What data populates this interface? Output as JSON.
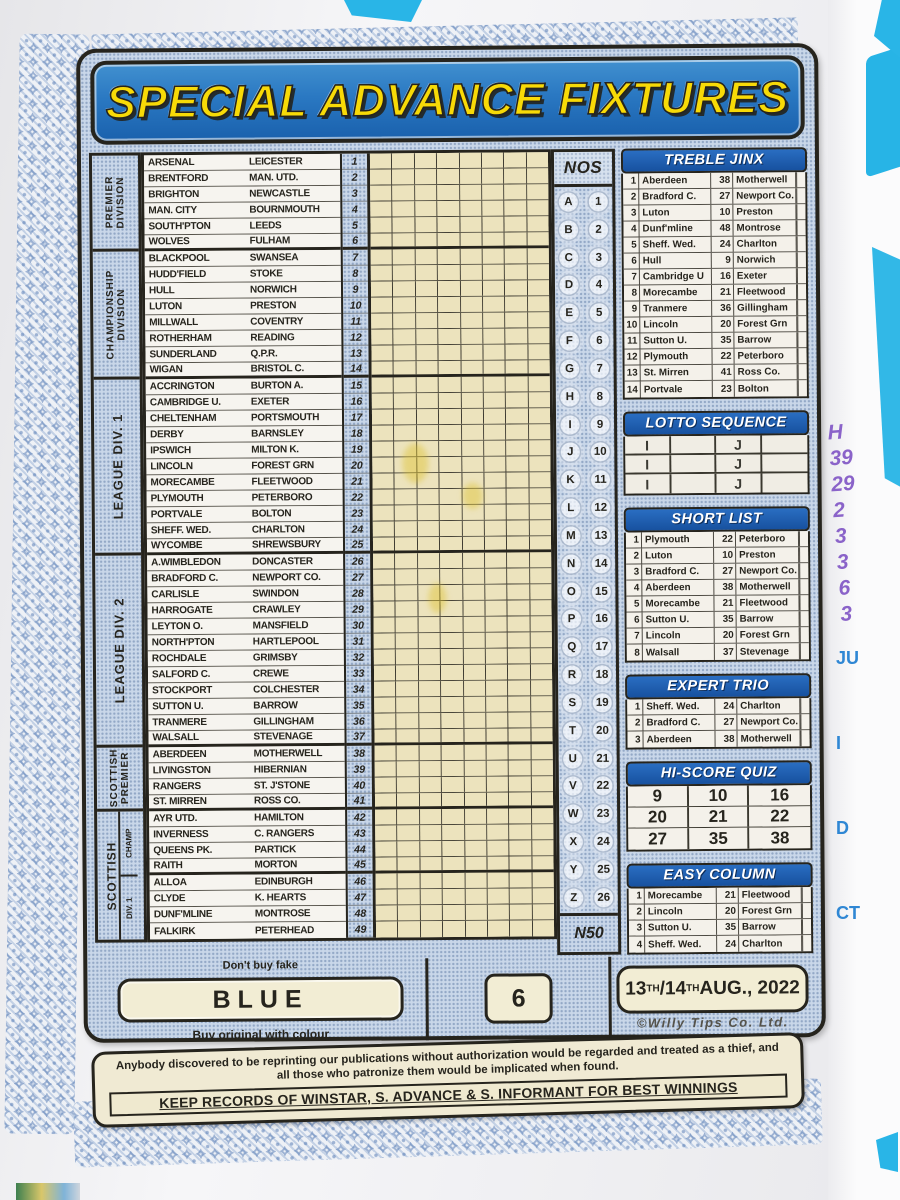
{
  "title": "SPECIAL ADVANCE FIXTURES",
  "divisions": [
    {
      "label1": "PREMIER",
      "label2": "DIVISION",
      "rows": 6
    },
    {
      "label1": "CHAMPIONSHIP",
      "label2": "DIVISION",
      "rows": 8
    },
    {
      "label1": "LEAGUE DIV. 1",
      "label2": "",
      "rows": 11
    },
    {
      "label1": "LEAGUE DIV. 2",
      "label2": "",
      "rows": 12
    },
    {
      "label1": "SCOTTISH",
      "label2": "PREMIER",
      "rows": 4
    },
    {
      "label1": "SCOTTISH",
      "label2": "",
      "rows": 8,
      "sub": [
        {
          "label": "CHAMP",
          "rows": 4
        },
        {
          "label": "DIV. 1",
          "rows": 4
        }
      ]
    }
  ],
  "fixtures": [
    {
      "no": "1",
      "home": "ARSENAL",
      "away": "LEICESTER"
    },
    {
      "no": "2",
      "home": "BRENTFORD",
      "away": "MAN. UTD."
    },
    {
      "no": "3",
      "home": "BRIGHTON",
      "away": "NEWCASTLE"
    },
    {
      "no": "4",
      "home": "MAN. CITY",
      "away": "BOURNMOUTH"
    },
    {
      "no": "5",
      "home": "SOUTH'PTON",
      "away": "LEEDS"
    },
    {
      "no": "6",
      "home": "WOLVES",
      "away": "FULHAM"
    },
    {
      "no": "7",
      "home": "BLACKPOOL",
      "away": "SWANSEA"
    },
    {
      "no": "8",
      "home": "HUDD'FIELD",
      "away": "STOKE"
    },
    {
      "no": "9",
      "home": "HULL",
      "away": "NORWICH"
    },
    {
      "no": "10",
      "home": "LUTON",
      "away": "PRESTON"
    },
    {
      "no": "11",
      "home": "MILLWALL",
      "away": "COVENTRY"
    },
    {
      "no": "12",
      "home": "ROTHERHAM",
      "away": "READING"
    },
    {
      "no": "13",
      "home": "SUNDERLAND",
      "away": "Q.P.R."
    },
    {
      "no": "14",
      "home": "WIGAN",
      "away": "BRISTOL C."
    },
    {
      "no": "15",
      "home": "ACCRINGTON",
      "away": "BURTON A."
    },
    {
      "no": "16",
      "home": "CAMBRIDGE U.",
      "away": "EXETER"
    },
    {
      "no": "17",
      "home": "CHELTENHAM",
      "away": "PORTSMOUTH"
    },
    {
      "no": "18",
      "home": "DERBY",
      "away": "BARNSLEY"
    },
    {
      "no": "19",
      "home": "IPSWICH",
      "away": "MILTON K."
    },
    {
      "no": "20",
      "home": "LINCOLN",
      "away": "FOREST GRN"
    },
    {
      "no": "21",
      "home": "MORECAMBE",
      "away": "FLEETWOOD"
    },
    {
      "no": "22",
      "home": "PLYMOUTH",
      "away": "PETERBORO"
    },
    {
      "no": "23",
      "home": "PORTVALE",
      "away": "BOLTON"
    },
    {
      "no": "24",
      "home": "SHEFF. WED.",
      "away": "CHARLTON"
    },
    {
      "no": "25",
      "home": "WYCOMBE",
      "away": "SHREWSBURY"
    },
    {
      "no": "26",
      "home": "A.WIMBLEDON",
      "away": "DONCASTER"
    },
    {
      "no": "27",
      "home": "BRADFORD C.",
      "away": "NEWPORT CO."
    },
    {
      "no": "28",
      "home": "CARLISLE",
      "away": "SWINDON"
    },
    {
      "no": "29",
      "home": "HARROGATE",
      "away": "CRAWLEY"
    },
    {
      "no": "30",
      "home": "LEYTON O.",
      "away": "MANSFIELD"
    },
    {
      "no": "31",
      "home": "NORTH'PTON",
      "away": "HARTLEPOOL"
    },
    {
      "no": "32",
      "home": "ROCHDALE",
      "away": "GRIMSBY"
    },
    {
      "no": "33",
      "home": "SALFORD C.",
      "away": "CREWE"
    },
    {
      "no": "34",
      "home": "STOCKPORT",
      "away": "COLCHESTER"
    },
    {
      "no": "35",
      "home": "SUTTON U.",
      "away": "BARROW"
    },
    {
      "no": "36",
      "home": "TRANMERE",
      "away": "GILLINGHAM"
    },
    {
      "no": "37",
      "home": "WALSALL",
      "away": "STEVENAGE"
    },
    {
      "no": "38",
      "home": "ABERDEEN",
      "away": "MOTHERWELL"
    },
    {
      "no": "39",
      "home": "LIVINGSTON",
      "away": "HIBERNIAN"
    },
    {
      "no": "40",
      "home": "RANGERS",
      "away": "ST. J'STONE"
    },
    {
      "no": "41",
      "home": "ST. MIRREN",
      "away": "ROSS CO."
    },
    {
      "no": "42",
      "home": "AYR UTD.",
      "away": "HAMILTON"
    },
    {
      "no": "43",
      "home": "INVERNESS",
      "away": "C. RANGERS"
    },
    {
      "no": "44",
      "home": "QUEENS PK.",
      "away": "PARTICK"
    },
    {
      "no": "45",
      "home": "RAITH",
      "away": "MORTON"
    },
    {
      "no": "46",
      "home": "ALLOA",
      "away": "EDINBURGH"
    },
    {
      "no": "47",
      "home": "CLYDE",
      "away": "K. HEARTS"
    },
    {
      "no": "48",
      "home": "DUNF'MLINE",
      "away": "MONTROSE"
    },
    {
      "no": "49",
      "home": "FALKIRK",
      "away": "PETERHEAD"
    }
  ],
  "grid_columns": 8,
  "division_breaks": [
    6,
    14,
    25,
    37,
    41,
    45
  ],
  "nos": {
    "header": "NOS",
    "pairs": [
      {
        "letter": "A",
        "num": "1"
      },
      {
        "letter": "B",
        "num": "2"
      },
      {
        "letter": "C",
        "num": "3"
      },
      {
        "letter": "D",
        "num": "4"
      },
      {
        "letter": "E",
        "num": "5"
      },
      {
        "letter": "F",
        "num": "6"
      },
      {
        "letter": "G",
        "num": "7"
      },
      {
        "letter": "H",
        "num": "8"
      },
      {
        "letter": "I",
        "num": "9"
      },
      {
        "letter": "J",
        "num": "10"
      },
      {
        "letter": "K",
        "num": "11"
      },
      {
        "letter": "L",
        "num": "12"
      },
      {
        "letter": "M",
        "num": "13"
      },
      {
        "letter": "N",
        "num": "14"
      },
      {
        "letter": "O",
        "num": "15"
      },
      {
        "letter": "P",
        "num": "16"
      },
      {
        "letter": "Q",
        "num": "17"
      },
      {
        "letter": "R",
        "num": "18"
      },
      {
        "letter": "S",
        "num": "19"
      },
      {
        "letter": "T",
        "num": "20"
      },
      {
        "letter": "U",
        "num": "21"
      },
      {
        "letter": "V",
        "num": "22"
      },
      {
        "letter": "W",
        "num": "23"
      },
      {
        "letter": "X",
        "num": "24"
      },
      {
        "letter": "Y",
        "num": "25"
      },
      {
        "letter": "Z",
        "num": "26"
      }
    ],
    "footer": "N50"
  },
  "panel_order": [
    "treble_jinx",
    "lotto_sequence",
    "short_list",
    "expert_trio",
    "hi_score_quiz",
    "easy_column"
  ],
  "panels": {
    "treble_jinx": {
      "title": "TREBLE JINX",
      "rows": [
        [
          "1",
          "Aberdeen",
          "38",
          "Motherwell"
        ],
        [
          "2",
          "Bradford C.",
          "27",
          "Newport Co."
        ],
        [
          "3",
          "Luton",
          "10",
          "Preston"
        ],
        [
          "4",
          "Dunf'mline",
          "48",
          "Montrose"
        ],
        [
          "5",
          "Sheff. Wed.",
          "24",
          "Charlton"
        ],
        [
          "6",
          "Hull",
          "9",
          "Norwich"
        ],
        [
          "7",
          "Cambridge U",
          "16",
          "Exeter"
        ],
        [
          "8",
          "Morecambe",
          "21",
          "Fleetwood"
        ],
        [
          "9",
          "Tranmere",
          "36",
          "Gillingham"
        ],
        [
          "10",
          "Lincoln",
          "20",
          "Forest Grn"
        ],
        [
          "11",
          "Sutton U.",
          "35",
          "Barrow"
        ],
        [
          "12",
          "Plymouth",
          "22",
          "Peterboro"
        ],
        [
          "13",
          "St. Mirren",
          "41",
          "Ross Co."
        ],
        [
          "14",
          "Portvale",
          "23",
          "Bolton"
        ]
      ]
    },
    "lotto_sequence": {
      "title": "LOTTO SEQUENCE",
      "rows": [
        [
          "I",
          "",
          "J",
          ""
        ],
        [
          "I",
          "",
          "J",
          ""
        ],
        [
          "I",
          "",
          "J",
          ""
        ]
      ]
    },
    "short_list": {
      "title": "SHORT LIST",
      "rows": [
        [
          "1",
          "Plymouth",
          "22",
          "Peterboro"
        ],
        [
          "2",
          "Luton",
          "10",
          "Preston"
        ],
        [
          "3",
          "Bradford C.",
          "27",
          "Newport Co."
        ],
        [
          "4",
          "Aberdeen",
          "38",
          "Motherwell"
        ],
        [
          "5",
          "Morecambe",
          "21",
          "Fleetwood"
        ],
        [
          "6",
          "Sutton U.",
          "35",
          "Barrow"
        ],
        [
          "7",
          "Lincoln",
          "20",
          "Forest Grn"
        ],
        [
          "8",
          "Walsall",
          "37",
          "Stevenage"
        ]
      ]
    },
    "expert_trio": {
      "title": "EXPERT TRIO",
      "rows": [
        [
          "1",
          "Sheff. Wed.",
          "24",
          "Charlton"
        ],
        [
          "2",
          "Bradford C.",
          "27",
          "Newport Co."
        ],
        [
          "3",
          "Aberdeen",
          "38",
          "Motherwell"
        ]
      ]
    },
    "hi_score_quiz": {
      "title": "HI-SCORE QUIZ",
      "grid": [
        [
          "9",
          "10",
          "16"
        ],
        [
          "20",
          "21",
          "22"
        ],
        [
          "27",
          "35",
          "38"
        ]
      ]
    },
    "easy_column": {
      "title": "EASY COLUMN",
      "rows": [
        [
          "1",
          "Morecambe",
          "21",
          "Fleetwood"
        ],
        [
          "2",
          "Lincoln",
          "20",
          "Forest Grn"
        ],
        [
          "3",
          "Sutton U.",
          "35",
          "Barrow"
        ],
        [
          "4",
          "Sheff. Wed.",
          "24",
          "Charlton"
        ]
      ]
    }
  },
  "footer": {
    "dont_buy_fake": "Don't buy fake",
    "color_name": "BLUE",
    "buy_original": "Buy original with colour",
    "week_number": "6",
    "date_parts": [
      {
        "t": "13"
      },
      {
        "t": "TH",
        "sup": true
      },
      {
        "t": "/14"
      },
      {
        "t": "TH",
        "sup": true
      },
      {
        "t": " AUG., 2022"
      }
    ],
    "company": "©Willy Tips Co. Ltd.",
    "disclaimer": "Anybody discovered to be reprinting our publications without authorization would be regarded and treated as a thief, and all those who patronize them would be implicated when found.",
    "keep_records": "KEEP RECORDS OF WINSTAR, S. ADVANCE & S. INFORMANT FOR BEST WINNINGS"
  },
  "colors": {
    "banner_blue": "#2a78c2",
    "title_yellow": "#f8da07",
    "panel_header_blue": "#1c5cb4",
    "coupon_dot_blue": "#c9d7e9",
    "grid_cream": "#ece3bd",
    "border_dark": "#26241d"
  },
  "background": {
    "handwritten_numbers": [
      "H",
      "39",
      "29",
      "2",
      "3",
      "3",
      "6",
      "3"
    ],
    "print_fragments": [
      "JU",
      "I",
      "D",
      "CT"
    ]
  }
}
